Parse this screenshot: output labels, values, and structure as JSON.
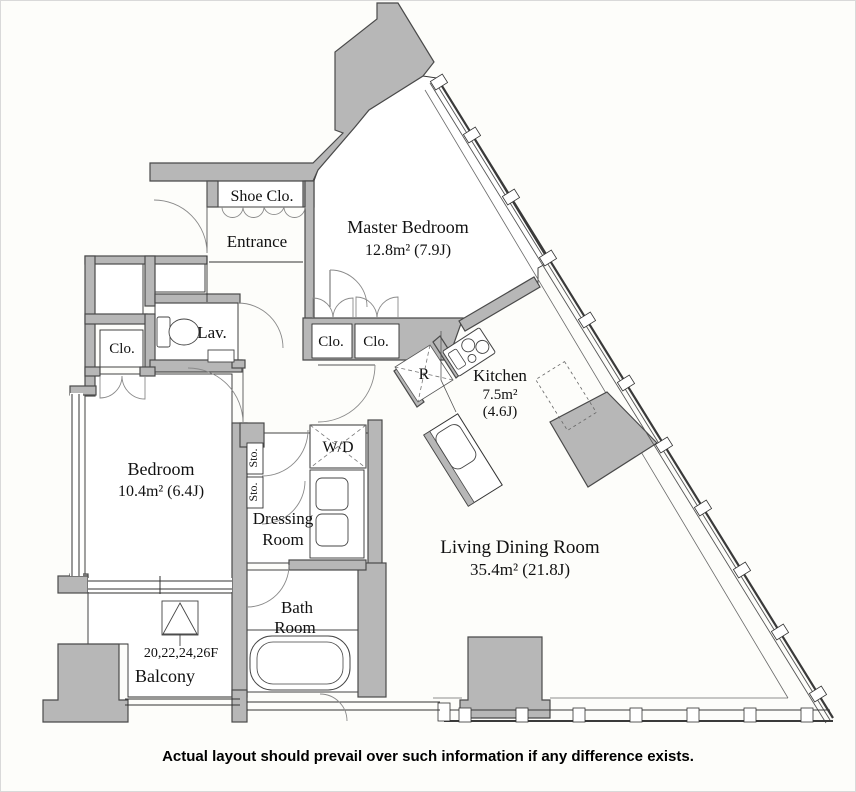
{
  "colors": {
    "background": "#fdfdfa",
    "wall_fill": "#b7b7b7",
    "wall_stroke": "#4a4a4a",
    "line": "#2f2f2f",
    "arc": "#8a8a8a"
  },
  "labels": {
    "shoe_closet": "Shoe Clo.",
    "entrance": "Entrance",
    "master_bedroom": "Master Bedroom",
    "master_bedroom_area": "12.8m²  (7.9J)",
    "lavatory": "Lav.",
    "closet_west": "Clo.",
    "closet_a": "Clo.",
    "closet_b": "Clo.",
    "refrigerator": "R",
    "kitchen": "Kitchen",
    "kitchen_area_m2": "7.5m²",
    "kitchen_area_j": "(4.6J)",
    "bedroom": "Bedroom",
    "bedroom_area": "10.4m²  (6.4J)",
    "washer_dryer": "W/D",
    "storage_a": "Sto.",
    "storage_b": "Sto.",
    "dressing_line1": "Dressing",
    "dressing_line2": "Room",
    "living_dining": "Living Dining Room",
    "living_dining_area": "35.4m²  (21.8J)",
    "bath_line1": "Bath",
    "bath_line2": "Room",
    "balcony": "Balcony",
    "balcony_floors": "20,22,24,26F"
  },
  "disclaimer": "Actual layout should prevail over such information if any difference exists."
}
